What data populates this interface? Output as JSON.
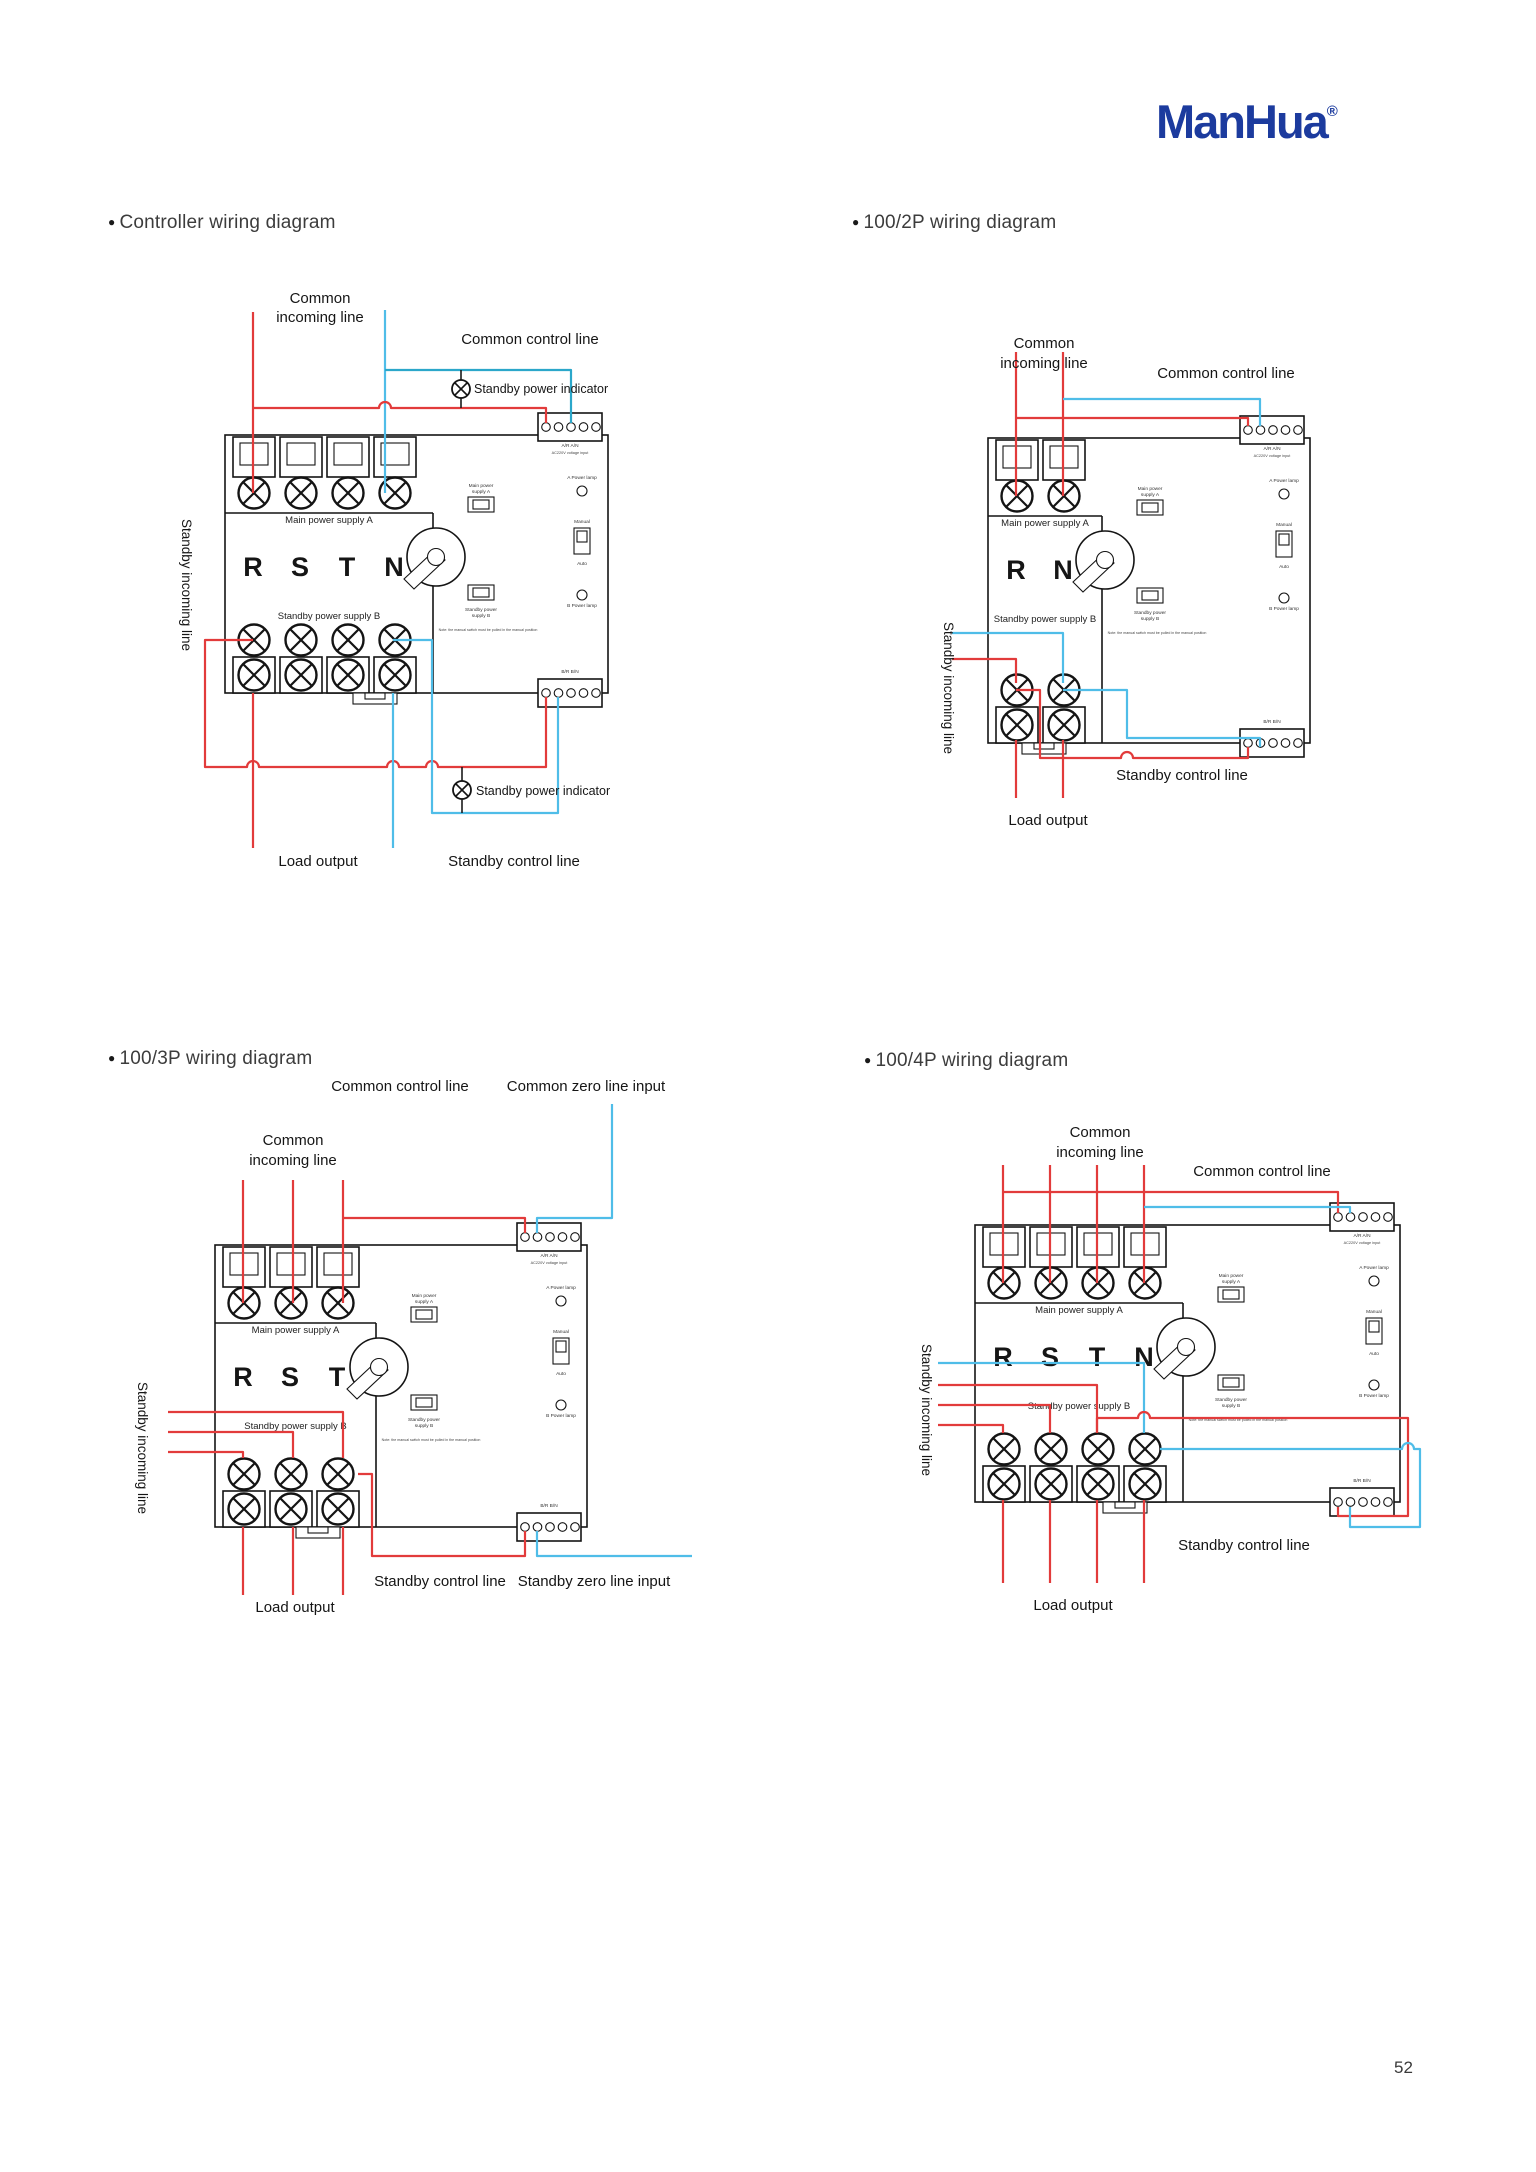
{
  "page": {
    "logo": "ManHua",
    "logo_reg": "®",
    "page_number": "52"
  },
  "headings": {
    "d1": "Controller wiring diagram",
    "d2": "100/2P wiring diagram",
    "d3": "100/3P wiring diagram",
    "d4": "100/4P wiring diagram"
  },
  "colors": {
    "wire_red": "#e23b3b",
    "wire_bl": "#4fbde8",
    "wire_teal": "#2ba7ca",
    "logo_blue": "#1c3b9e"
  },
  "device_labels": {
    "main_supply": "Main power supply A",
    "standby_supply": "Standby power supply B",
    "a_lamp": "A Power lamp",
    "b_lamp": "B Power lamp",
    "manual": "Manual",
    "auto": "Auto",
    "ind_main_1": "Main power",
    "ind_main_2": "supply A",
    "ind_standby_1": "Standby power",
    "ind_standby_2": "supply B",
    "note": "Note: the manual switch must be pulled in the manual position",
    "top_terminals": "A/R   A/N",
    "top_terminals_sub": "AC220V voltage input",
    "bottom_terminals": "B/R   B/N"
  },
  "diagrams": {
    "d1": {
      "letters": [
        "R",
        "S",
        "T",
        "N"
      ],
      "labels": {
        "common_1": "Common",
        "common_2": "incoming line",
        "common_control": "Common control line",
        "standby_indicator": "Standby power indicator",
        "standby_incoming": "Standby incoming line",
        "load_output": "Load output",
        "standby_control": "Standby control line"
      }
    },
    "d2": {
      "letters": [
        "R",
        "N"
      ],
      "labels": {
        "common_1": "Common",
        "common_2": "incoming line",
        "common_control": "Common control line",
        "standby_incoming": "Standby incoming line",
        "load_output": "Load output",
        "standby_control": "Standby control line"
      }
    },
    "d3": {
      "letters": [
        "R",
        "S",
        "T"
      ],
      "labels": {
        "common_1": "Common",
        "common_2": "incoming line",
        "common_control": "Common control line",
        "common_zero": "Common zero line input",
        "standby_incoming": "Standby incoming line",
        "load_output": "Load output",
        "standby_control": "Standby control line",
        "standby_zero": "Standby zero line input"
      }
    },
    "d4": {
      "letters": [
        "R",
        "S",
        "T",
        "N"
      ],
      "labels": {
        "common_1": "Common",
        "common_2": "incoming line",
        "common_control": "Common control line",
        "standby_incoming": "Standby incoming line",
        "load_output": "Load output",
        "standby_control": "Standby control line"
      }
    }
  }
}
